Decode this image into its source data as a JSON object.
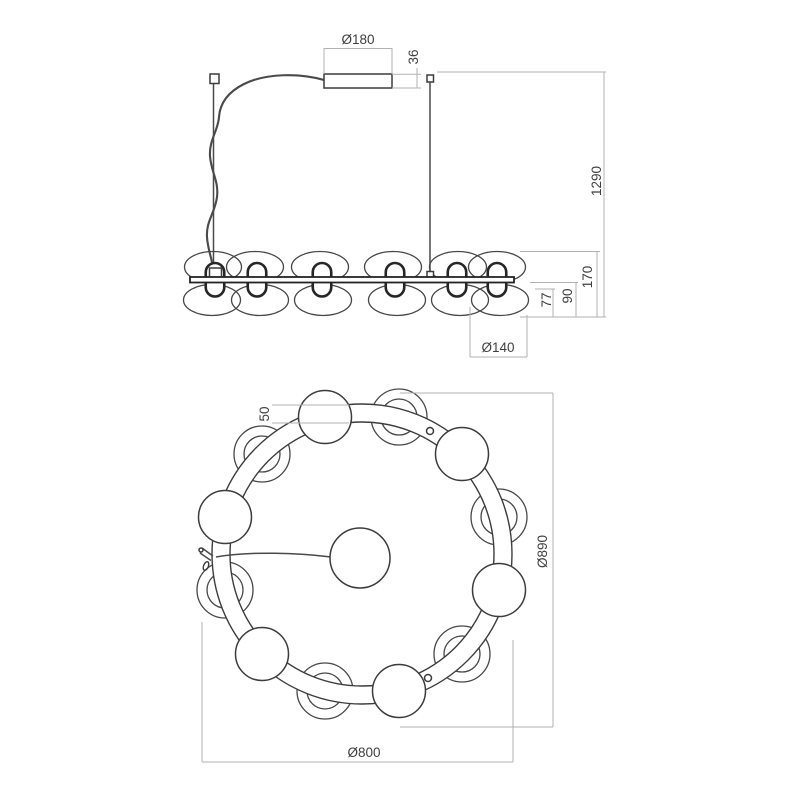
{
  "drawing": {
    "type": "pendant-luminaire-dimension-drawing",
    "colors": {
      "linework": "#3c3c3c",
      "dimension_lines": "#b2b2b2",
      "dimension_text": "#3f3f3f",
      "background": "#ffffff"
    },
    "front_view": {
      "labels": {
        "canopy_diameter": "Ø180",
        "canopy_height": "36",
        "suspension_height": "1290",
        "fixture_height": "170",
        "lower_body_height": "90",
        "glass_drop": "77",
        "glass_diameter": "Ø140"
      }
    },
    "top_view": {
      "labels": {
        "ring_tube_width": "50",
        "overall_diameter": "Ø890",
        "ring_diameter": "Ø800"
      }
    }
  }
}
